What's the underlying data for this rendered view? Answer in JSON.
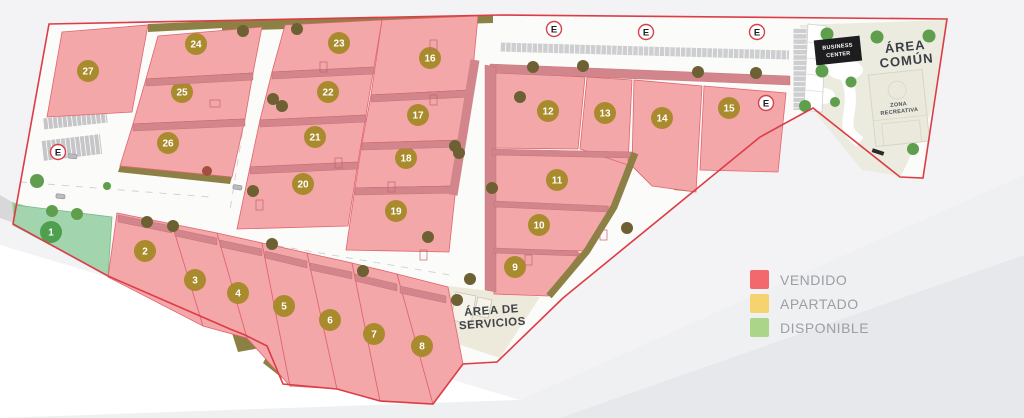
{
  "legend": {
    "items": [
      {
        "key": "vendido",
        "label": "VENDIDO",
        "color": "#f2686c"
      },
      {
        "key": "apartado",
        "label": "APARTADO",
        "color": "#f6d36e"
      },
      {
        "key": "disponible",
        "label": "DISPONIBLE",
        "color": "#abd689"
      }
    ]
  },
  "areas": {
    "area_comun": {
      "lines": [
        "ÁREA",
        "COMÚN"
      ]
    },
    "zona_recreativa": {
      "lines": [
        "ZONA",
        "RECREATIVA"
      ]
    },
    "business_center": {
      "lines": [
        "BUSINESS",
        "CENTER"
      ]
    },
    "area_servicios": {
      "lines": [
        "ÁREA DE",
        "SERVICIOS"
      ]
    }
  },
  "entrance_marker": {
    "symbol": "E",
    "positions": [
      {
        "x": 58,
        "y": 152
      },
      {
        "x": 554,
        "y": 29
      },
      {
        "x": 646,
        "y": 32
      },
      {
        "x": 757,
        "y": 32
      },
      {
        "x": 766,
        "y": 103
      }
    ]
  },
  "status_colors": {
    "vendido": {
      "fill": "#f3a7a9",
      "stroke": "#e2646e",
      "badge": "#a98b2e"
    },
    "apartado": {
      "fill": "#f6d36e",
      "stroke": "#d9b23f",
      "badge": "#b38f2c"
    },
    "disponible": {
      "fill": "#a2d5ae",
      "stroke": "#76b886",
      "badge": "#4ea04f"
    }
  },
  "boundary_color": "#dd3c46",
  "lots": [
    {
      "number": 1,
      "status": "disponible",
      "badge": {
        "x": 51,
        "y": 232
      },
      "points": "15,205 112,217 108,276 13,225"
    },
    {
      "number": 2,
      "status": "vendido",
      "badge": {
        "x": 145,
        "y": 251
      },
      "points": "117,213 172,224 203,326 108,277"
    },
    {
      "number": 3,
      "status": "vendido",
      "badge": {
        "x": 195,
        "y": 280
      },
      "points": "172,224 217,233 247,338 203,326"
    },
    {
      "number": 4,
      "status": "vendido",
      "badge": {
        "x": 238,
        "y": 293
      },
      "points": "217,233 262,243 290,386 247,338"
    },
    {
      "number": 5,
      "status": "vendido",
      "badge": {
        "x": 284,
        "y": 306
      },
      "points": "262,243 307,253 337,389 290,386"
    },
    {
      "number": 6,
      "status": "vendido",
      "badge": {
        "x": 330,
        "y": 320
      },
      "points": "307,253 352,263 380,401 337,389"
    },
    {
      "number": 7,
      "status": "vendido",
      "badge": {
        "x": 374,
        "y": 334
      },
      "points": "352,263 397,274 433,404 380,401"
    },
    {
      "number": 8,
      "status": "vendido",
      "badge": {
        "x": 422,
        "y": 346
      },
      "points": "397,274 448,287 463,364 433,404"
    },
    {
      "number": 9,
      "status": "vendido",
      "badge": {
        "x": 515,
        "y": 267
      },
      "points": "494,250 580,253 548,296 494,294"
    },
    {
      "number": 10,
      "status": "vendido",
      "badge": {
        "x": 539,
        "y": 225
      },
      "points": "494,203 610,208 585,251 494,249"
    },
    {
      "number": 11,
      "status": "vendido",
      "badge": {
        "x": 557,
        "y": 180
      },
      "points": "492,150 635,153 612,207 494,202"
    },
    {
      "number": 12,
      "status": "vendido",
      "badge": {
        "x": 548,
        "y": 111
      },
      "points": "490,72 585,77 578,149 491,148"
    },
    {
      "number": 13,
      "status": "vendido",
      "badge": {
        "x": 605,
        "y": 113
      },
      "points": "587,77 632,80 628,165 580,149"
    },
    {
      "number": 14,
      "status": "vendido",
      "badge": {
        "x": 662,
        "y": 118
      },
      "points": "634,80 702,86 696,192 652,186 632,166"
    },
    {
      "number": 15,
      "status": "vendido",
      "badge": {
        "x": 729,
        "y": 108
      },
      "points": "704,86 786,93 778,172 700,170"
    },
    {
      "number": 16,
      "status": "vendido",
      "badge": {
        "x": 430,
        "y": 58
      },
      "points": "382,20 478,16 471,90 371,95"
    },
    {
      "number": 17,
      "status": "vendido",
      "badge": {
        "x": 418,
        "y": 115
      },
      "points": "371,95 471,90 463,140 362,143"
    },
    {
      "number": 18,
      "status": "vendido",
      "badge": {
        "x": 406,
        "y": 158
      },
      "points": "362,143 463,140 456,186 355,188"
    },
    {
      "number": 19,
      "status": "vendido",
      "badge": {
        "x": 396,
        "y": 211
      },
      "points": "355,188 456,186 449,252 346,250"
    },
    {
      "number": 20,
      "status": "vendido",
      "badge": {
        "x": 303,
        "y": 184
      },
      "points": "250,167 358,162 348,226 237,229"
    },
    {
      "number": 21,
      "status": "vendido",
      "badge": {
        "x": 315,
        "y": 137
      },
      "points": "260,120 366,115 358,162 250,167"
    },
    {
      "number": 22,
      "status": "vendido",
      "badge": {
        "x": 328,
        "y": 92
      },
      "points": "272,72 374,67 366,115 260,120"
    },
    {
      "number": 23,
      "status": "vendido",
      "badge": {
        "x": 339,
        "y": 43
      },
      "points": "285,25 382,20 374,67 272,72"
    },
    {
      "number": 24,
      "status": "vendido",
      "badge": {
        "x": 196,
        "y": 44
      },
      "points": "158,36 262,27 253,73 146,79"
    },
    {
      "number": 25,
      "status": "vendido",
      "badge": {
        "x": 182,
        "y": 92
      },
      "points": "146,79 253,73 245,119 133,124"
    },
    {
      "number": 26,
      "status": "vendido",
      "badge": {
        "x": 168,
        "y": 143
      },
      "points": "133,124 245,119 232,177 120,166"
    },
    {
      "number": 27,
      "status": "vendido",
      "badge": {
        "x": 88,
        "y": 71
      },
      "points": "62,32 148,25 132,112 47,117"
    }
  ]
}
